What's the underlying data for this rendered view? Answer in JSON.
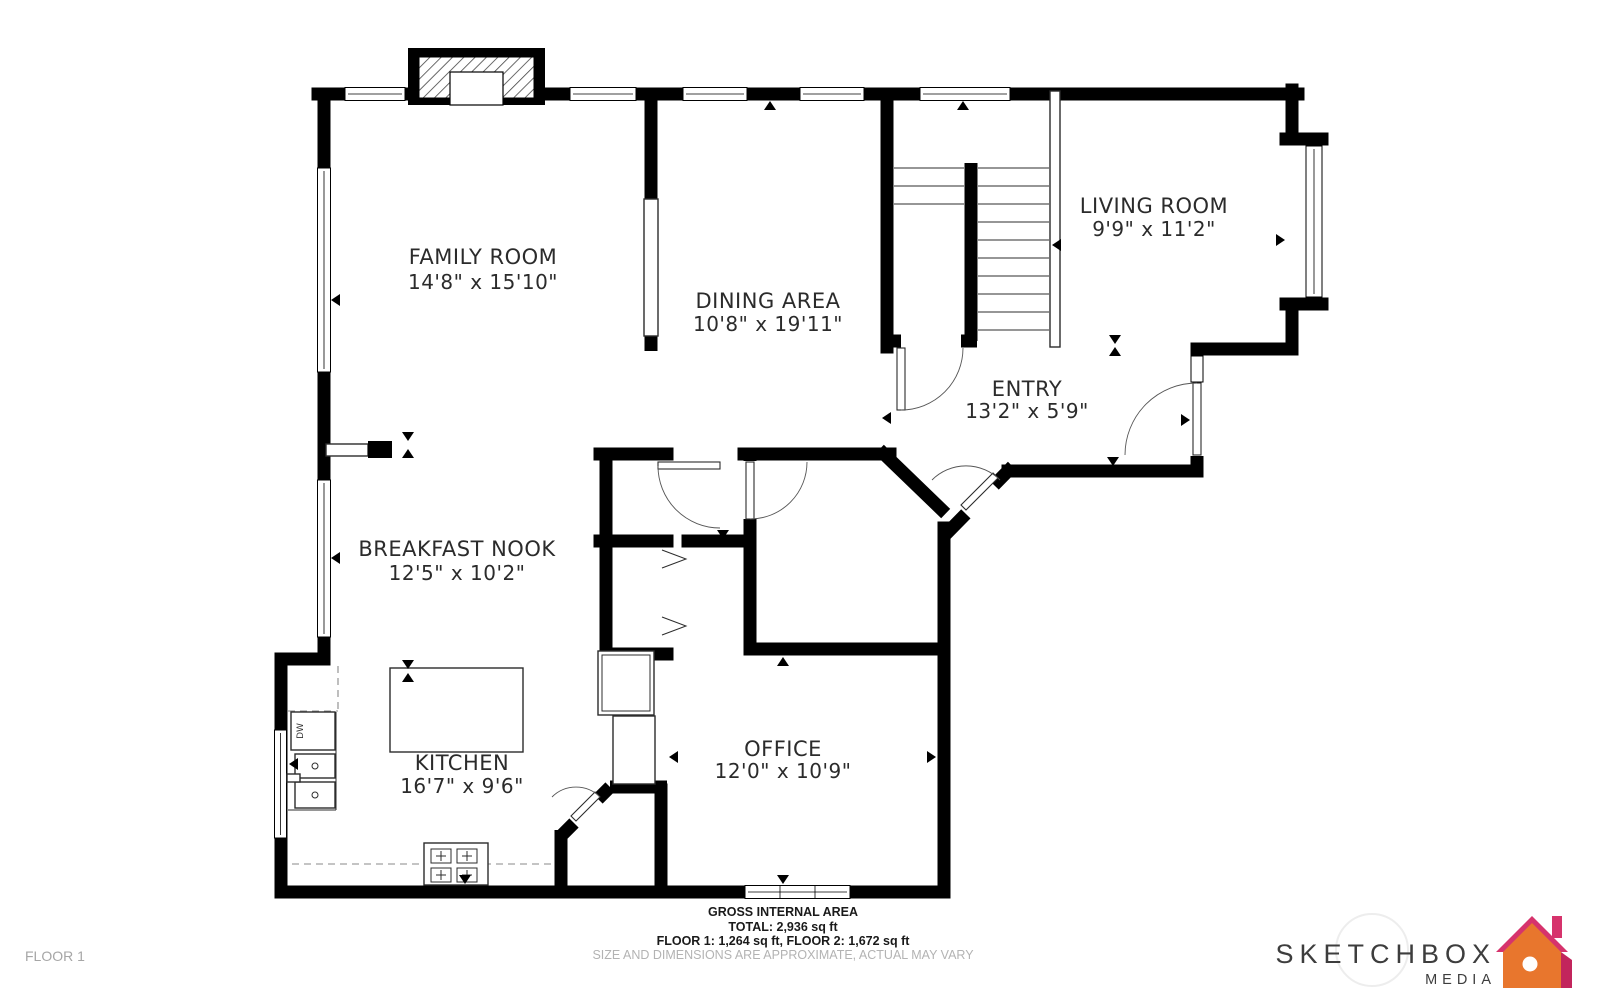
{
  "plan": {
    "floor_label": "FLOOR 1",
    "rooms": [
      {
        "name": "FAMILY ROOM",
        "dims": "14'8\" x 15'10\""
      },
      {
        "name": "DINING AREA",
        "dims": "10'8\" x 19'11\""
      },
      {
        "name": "LIVING ROOM",
        "dims": "9'9\" x 11'2\""
      },
      {
        "name": "ENTRY",
        "dims": "13'2\" x 5'9\""
      },
      {
        "name": "BREAKFAST NOOK",
        "dims": "12'5\" x 10'2\""
      },
      {
        "name": "KITCHEN",
        "dims": "16'7\" x 9'6\""
      },
      {
        "name": "OFFICE",
        "dims": "12'0\" x 10'9\""
      }
    ],
    "kitchen": {
      "dishwasher_label": "DW"
    }
  },
  "footer": {
    "area_title": "GROSS INTERNAL AREA",
    "total": "TOTAL: 2,936 sq ft",
    "floors": "FLOOR 1: 1,264 sq ft, FLOOR 2: 1,672 sq ft",
    "disclaimer": "SIZE AND DIMENSIONS ARE APPROXIMATE, ACTUAL MAY VARY"
  },
  "branding": {
    "company": "SKETCHBOX",
    "company_sub": "MEDIA",
    "house_orange": "#e8762d",
    "house_magenta": "#d6336c",
    "house_dark_magenta": "#c2255c"
  },
  "colors": {
    "wall": "#000000",
    "label_text": "#2b2b2b",
    "footer_text": "#1a1a1a",
    "muted_text": "#b3b3b3",
    "logo_text": "#3d3d3d"
  }
}
